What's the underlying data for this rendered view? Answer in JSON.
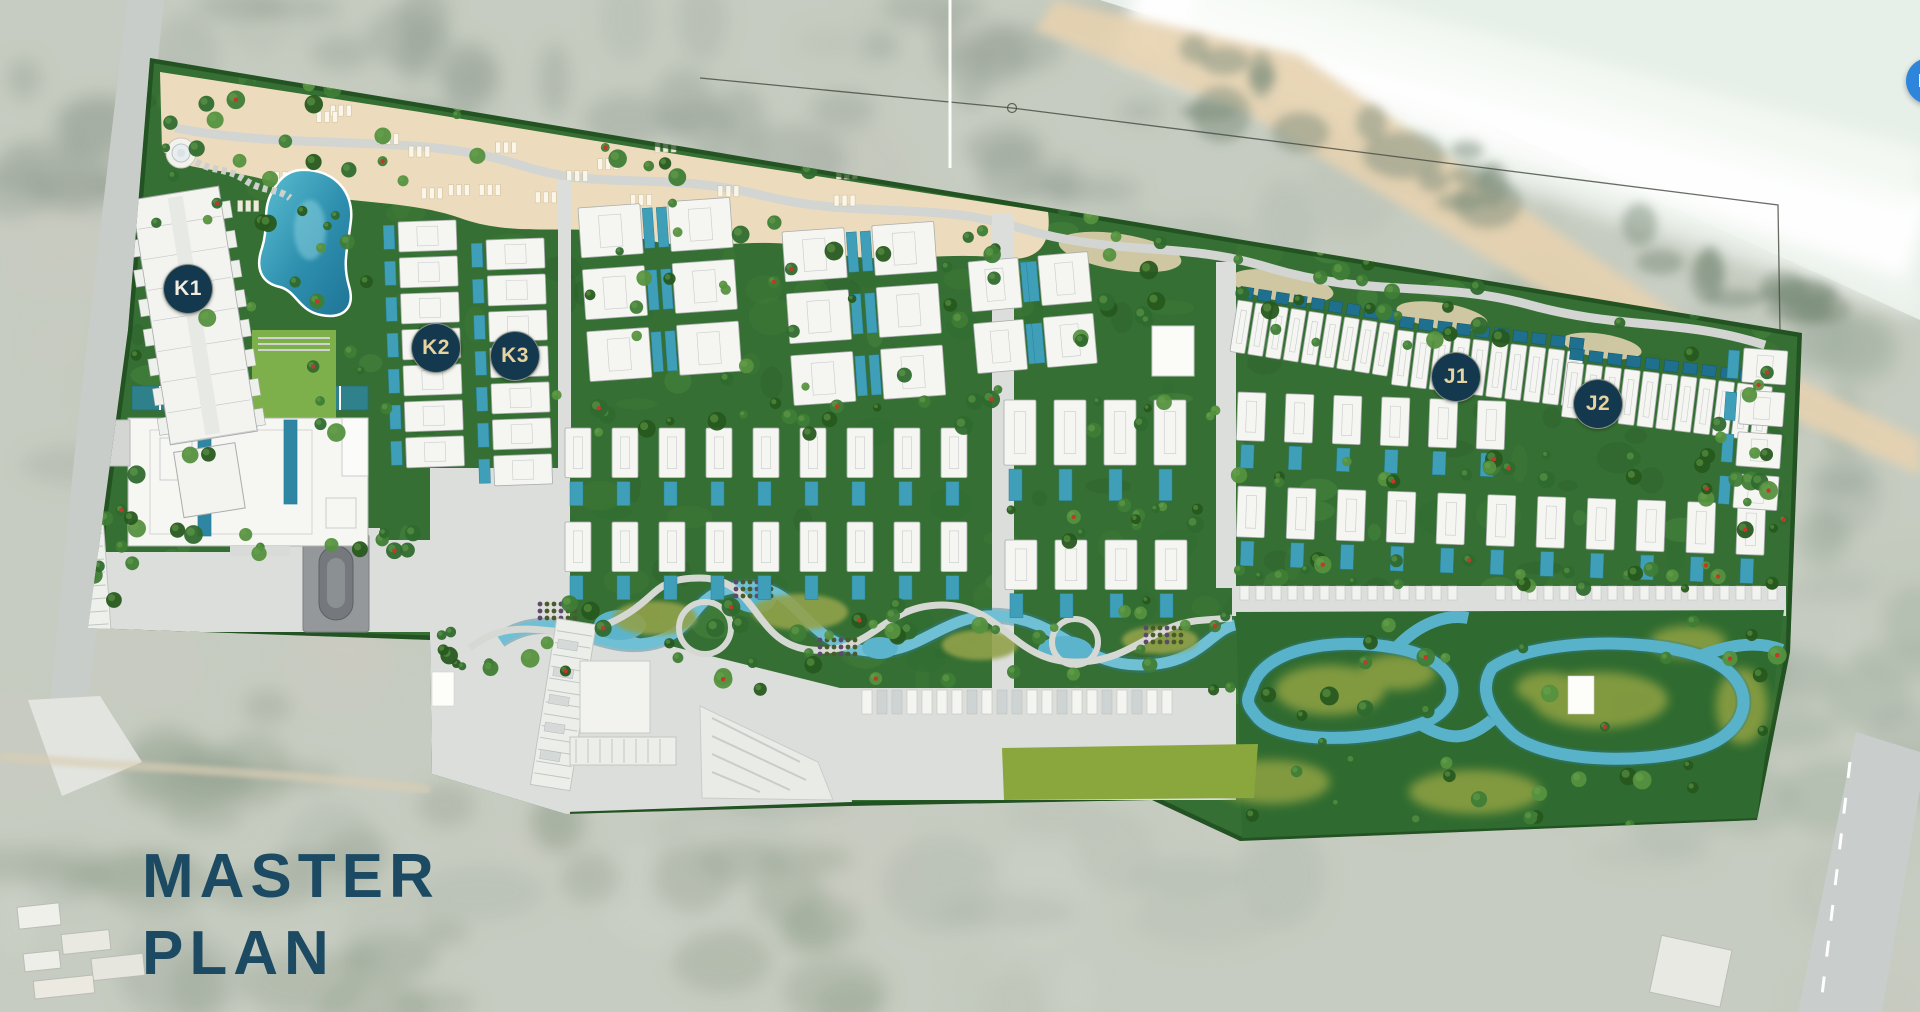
{
  "page": {
    "description": "Aerial master plan rendering of a beachfront resort-residence development overlaid on faded satellite imagery"
  },
  "title": {
    "line1": "MASTER",
    "line2": "PLAN",
    "color": "#1b4a62"
  },
  "map": {
    "badge_bg": "#14384e",
    "badge_ring": "rgba(236,221,178,0.55)",
    "badges": [
      {
        "id": "K1",
        "label": "K1",
        "x": 188,
        "y": 289,
        "text_color": "#f1ede0"
      },
      {
        "id": "K2",
        "label": "K2",
        "x": 436,
        "y": 348,
        "text_color": "#e7d3a0"
      },
      {
        "id": "K3",
        "label": "K3",
        "x": 515,
        "y": 356,
        "text_color": "#e7d3a0"
      },
      {
        "id": "J1",
        "label": "J1",
        "x": 1456,
        "y": 377,
        "text_color": "#e7d3a0"
      },
      {
        "id": "J2",
        "label": "J2",
        "x": 1598,
        "y": 404,
        "text_color": "#e7d3a0"
      }
    ],
    "colors": {
      "site_green": "#356f33",
      "dark_hedge": "#1e4a1d",
      "sand": "#ecdcbd",
      "road": "#dcdedb",
      "pool_teal": "#3f9fb8",
      "stream_blue": "#58b2ca",
      "olive_patch": "#8da043",
      "lawn_bright": "#8aa73d",
      "building_white": "#f5f5f2",
      "sea_foam": "#f3f7f2",
      "beach_sand": "#e6d2b0",
      "satellite_base": "#bcc3b5"
    }
  },
  "chat_button": {
    "icon": "chat-bubble-icon",
    "color": "#2e86dc"
  }
}
